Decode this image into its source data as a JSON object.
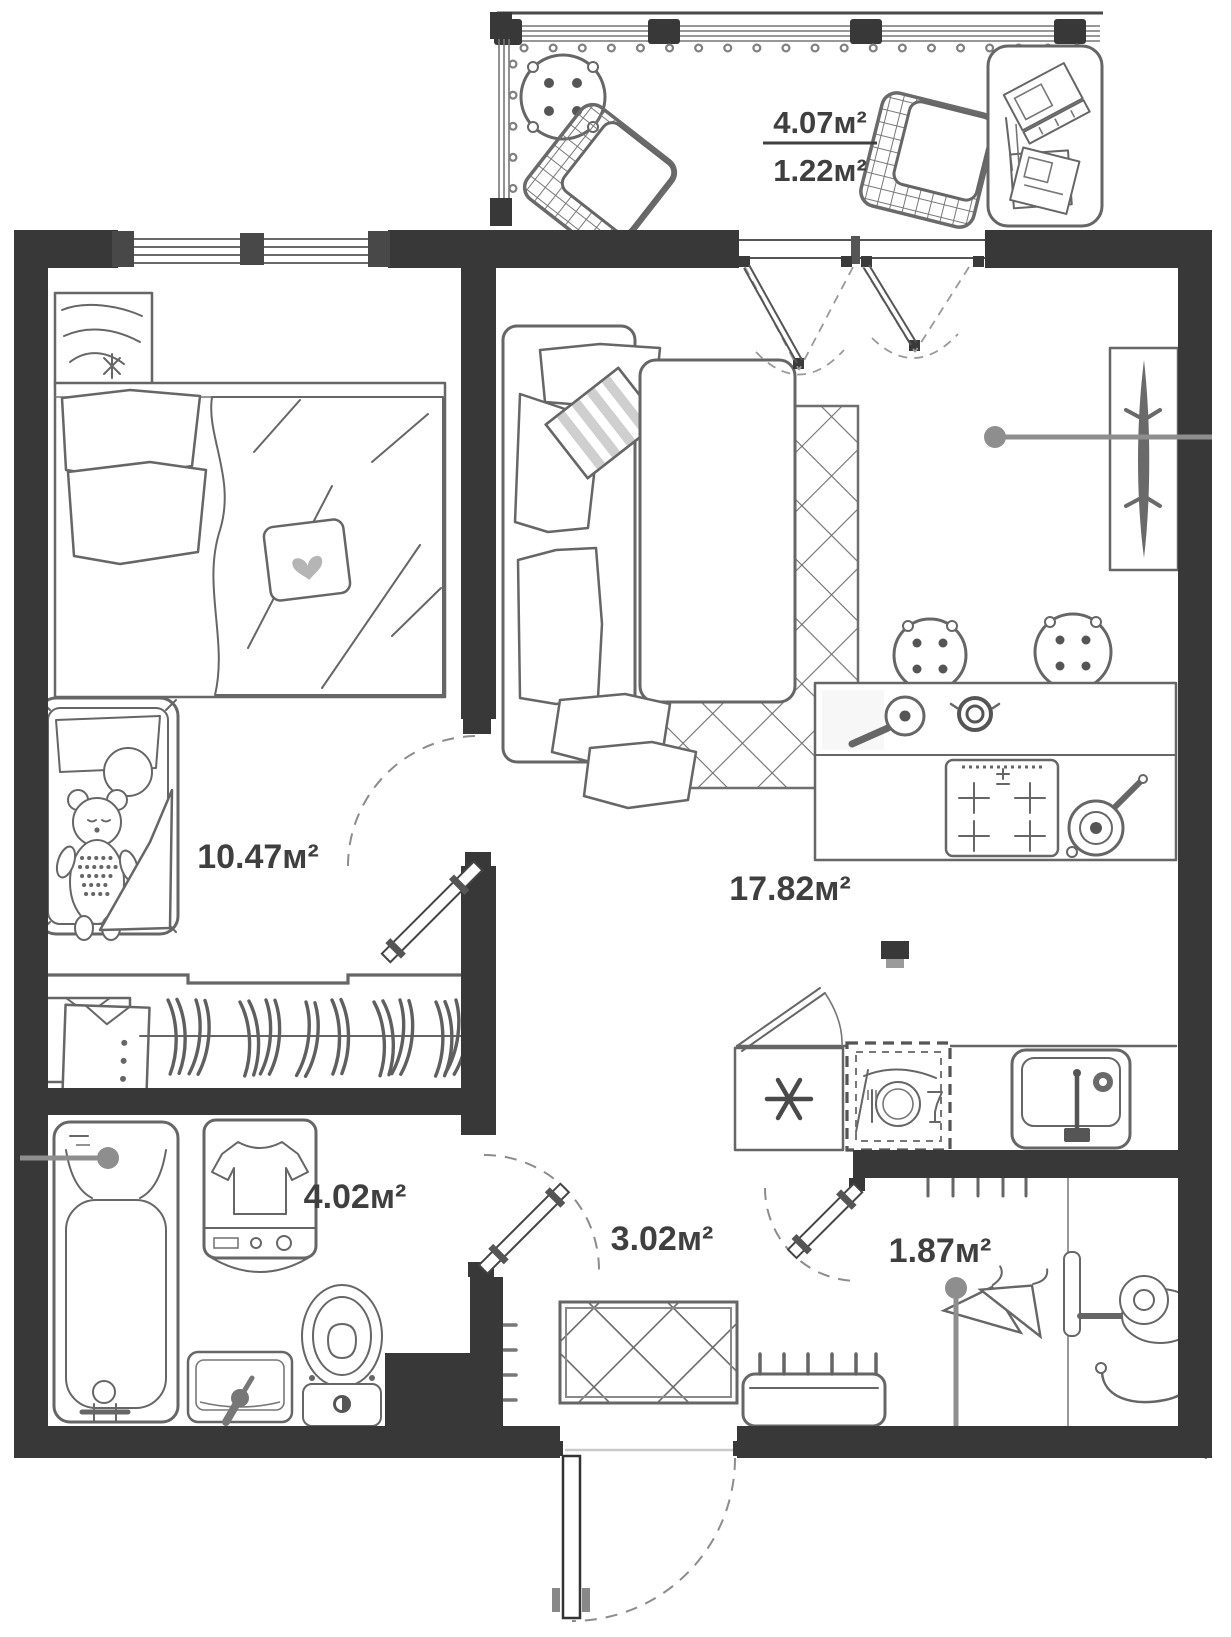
{
  "title": "Apartment floor plan",
  "colors": {
    "wall": "#383838",
    "furniture_outline": "#666666",
    "label_text": "#3f3f3f",
    "leader": "#8e8e8e",
    "background": "#ffffff"
  },
  "rooms": {
    "balcony": {
      "label": "balcony",
      "area_total": "4.07м²",
      "area_counted": "1.22м²"
    },
    "bedroom": {
      "label": "bedroom",
      "area": "10.47м²"
    },
    "living_kitchen": {
      "label": "living room-kitchen",
      "area": "17.82м²"
    },
    "bathroom": {
      "label": "bathroom",
      "area": "4.02м²"
    },
    "hallway": {
      "label": "hallway",
      "area": "3.02м²"
    },
    "closet": {
      "label": "closet",
      "area": "1.87м²"
    }
  },
  "icons": [
    "round-table-icon",
    "wicker-chair-icon",
    "desk-icon",
    "laptop-icon",
    "papers-icon",
    "dresser-icon",
    "double-bed-icon",
    "heart-pillow-icon",
    "crib-icon",
    "teddy-bear-icon",
    "shirts-icon",
    "wardrobe-hangers-icon",
    "sofa-icon",
    "striped-cushion-icon",
    "rug-icon",
    "bar-stool-icon",
    "kitchen-island-icon",
    "stove-icon",
    "frying-pan-icon",
    "pot-icon",
    "tv-icon",
    "fridge-icon",
    "dishwasher-icon",
    "kitchen-sink-icon",
    "bathtub-icon",
    "washing-machine-icon",
    "toilet-icon",
    "basin-icon",
    "doormat-icon",
    "shoe-bench-icon",
    "entrance-door-icon",
    "vacuum-cleaner-icon",
    "coat-hangers-icon",
    "leader-pin-icon"
  ]
}
